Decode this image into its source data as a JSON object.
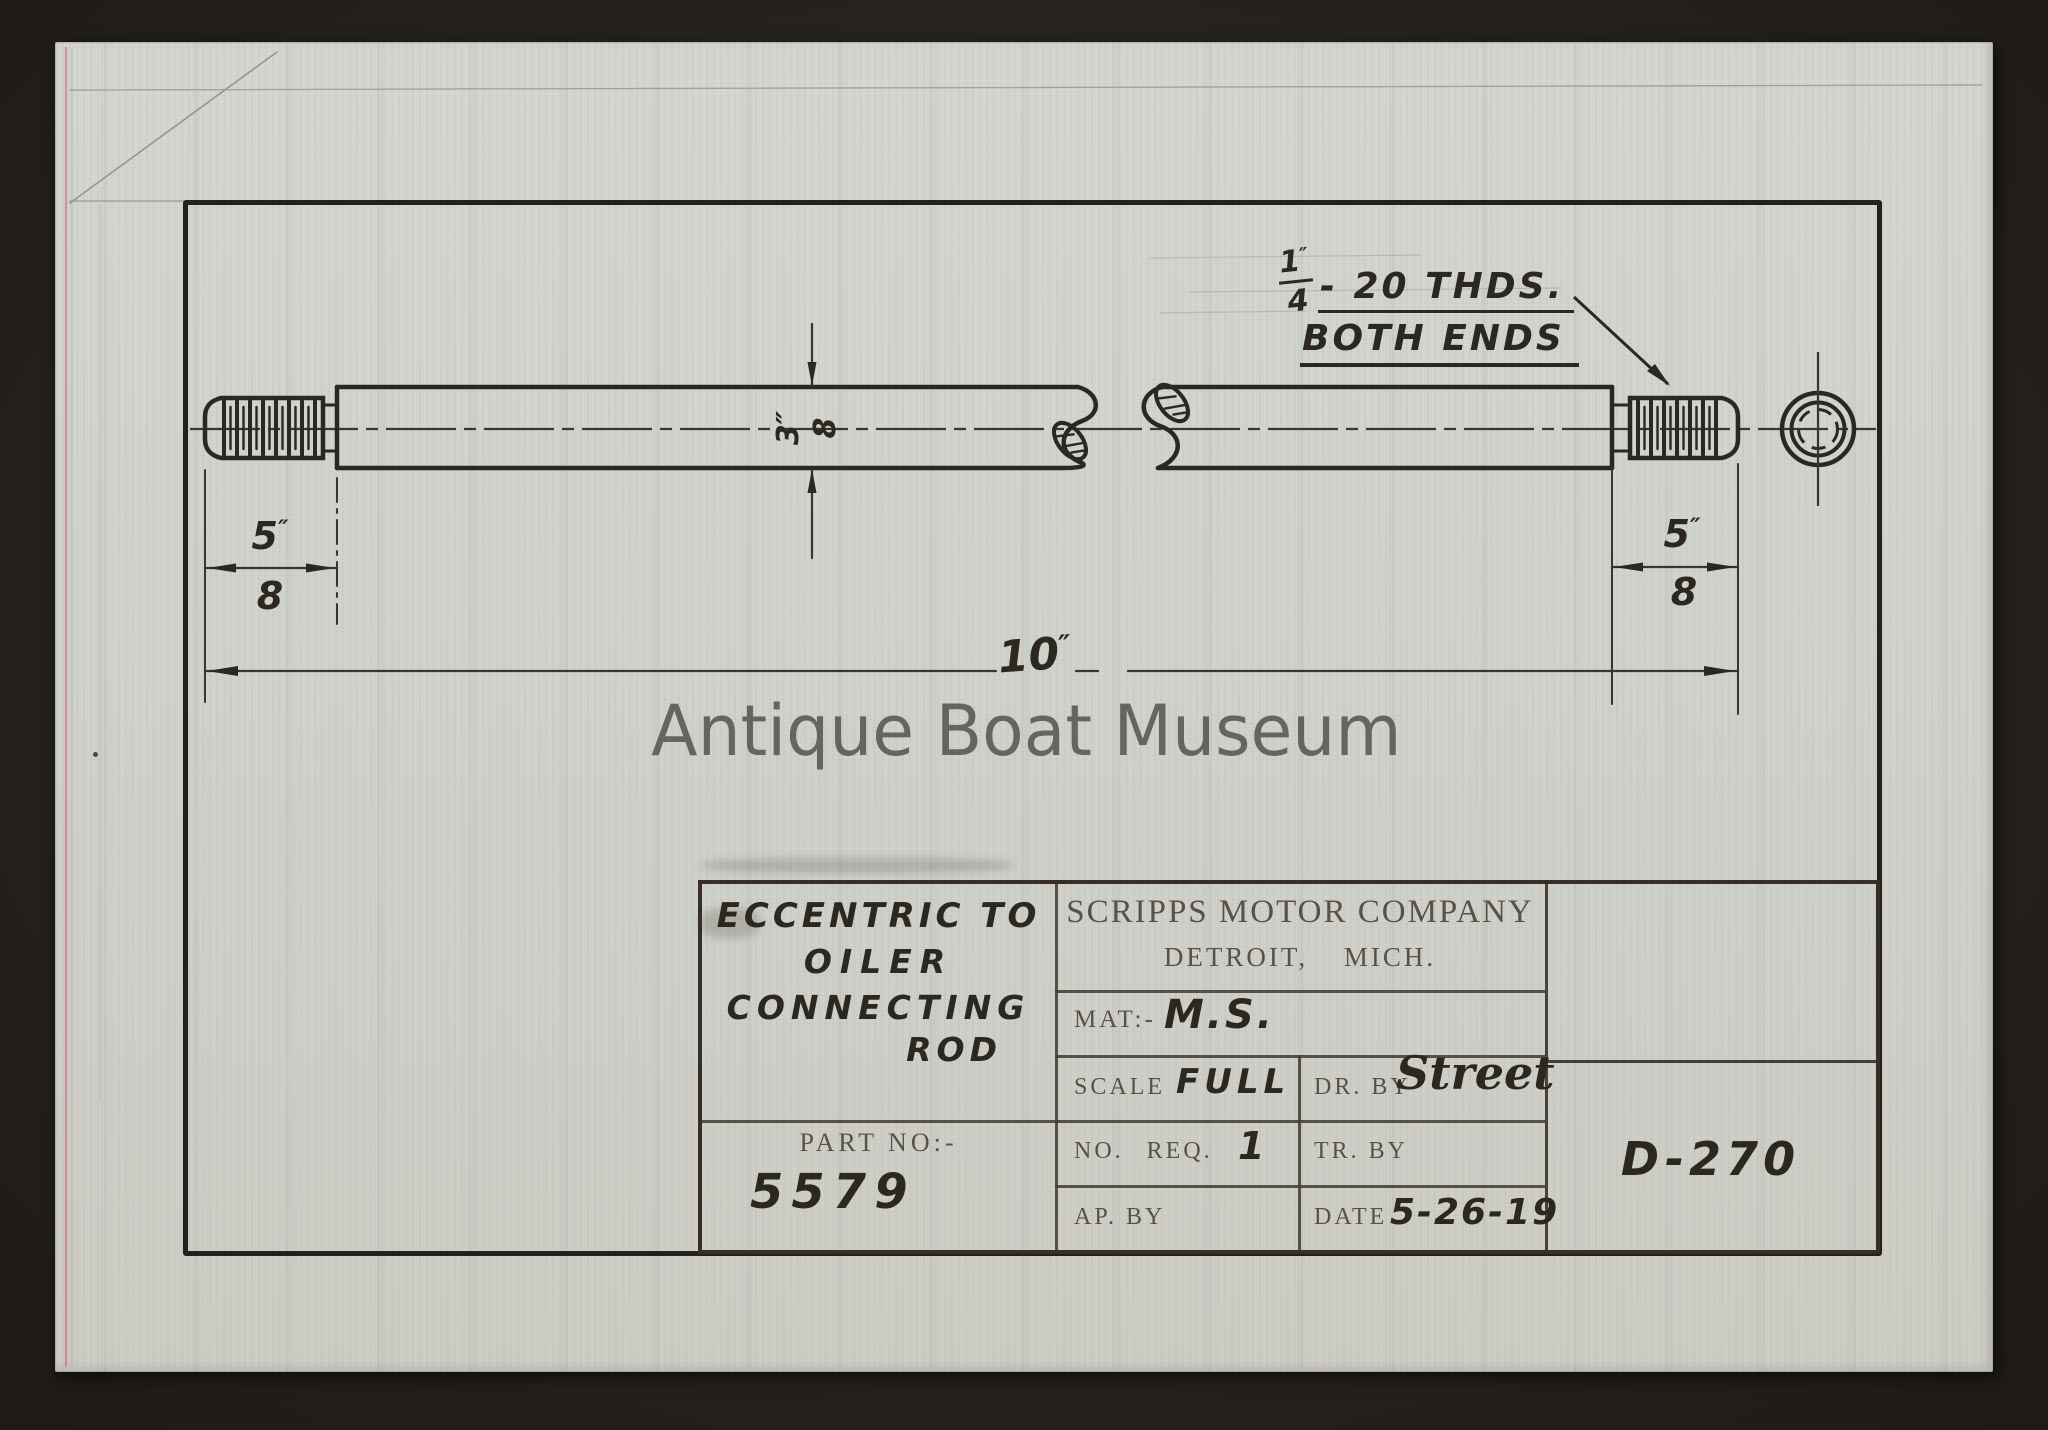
{
  "colors": {
    "paper": "#d1d3cd",
    "ink": "#2b2722",
    "pencil": "#4a4036",
    "printed_label": "#5b5046",
    "watermark": "#4b4b49",
    "selvage_red": "#bb5f6b",
    "mat_background": "#262220"
  },
  "watermark_text": "Antique Boat Museum",
  "drawing": {
    "thread_note": {
      "numerator": "1",
      "unit": "″",
      "denominator": "4",
      "note_line1": "- 20 THDS.",
      "note_line2": "BOTH ENDS"
    },
    "dim_diameter": {
      "numerator": "3",
      "unit": "″",
      "denominator": "8"
    },
    "dim_left_thread_length": {
      "numerator": "5",
      "unit": "″",
      "denominator": "8"
    },
    "dim_right_thread_length": {
      "numerator": "5",
      "unit": "″",
      "denominator": "8"
    },
    "dim_overall_length": {
      "value": "10",
      "unit": "″"
    }
  },
  "title_block": {
    "title_lines": [
      "ECCENTRIC TO",
      "OILER",
      "CONNECTING",
      "ROD"
    ],
    "company_name": "SCRIPPS MOTOR COMPANY",
    "company_location": "DETROIT, MICH.",
    "material_label": "MAT:-",
    "material_value": "M.S.",
    "scale_label": "SCALE",
    "scale_value": "FULL",
    "drawn_by_label": "DR. BY",
    "drawn_by_value": "Street",
    "no_req_label": "NO. REQ.",
    "no_req_value": "1",
    "traced_by_label": "TR. BY",
    "traced_by_value": "",
    "approved_by_label": "AP. BY",
    "approved_by_value": "",
    "date_label": "DATE",
    "date_value": "5-26-19",
    "part_no_label": "PART NO:-",
    "part_no_value": "5579",
    "drawing_number": "D-270"
  }
}
